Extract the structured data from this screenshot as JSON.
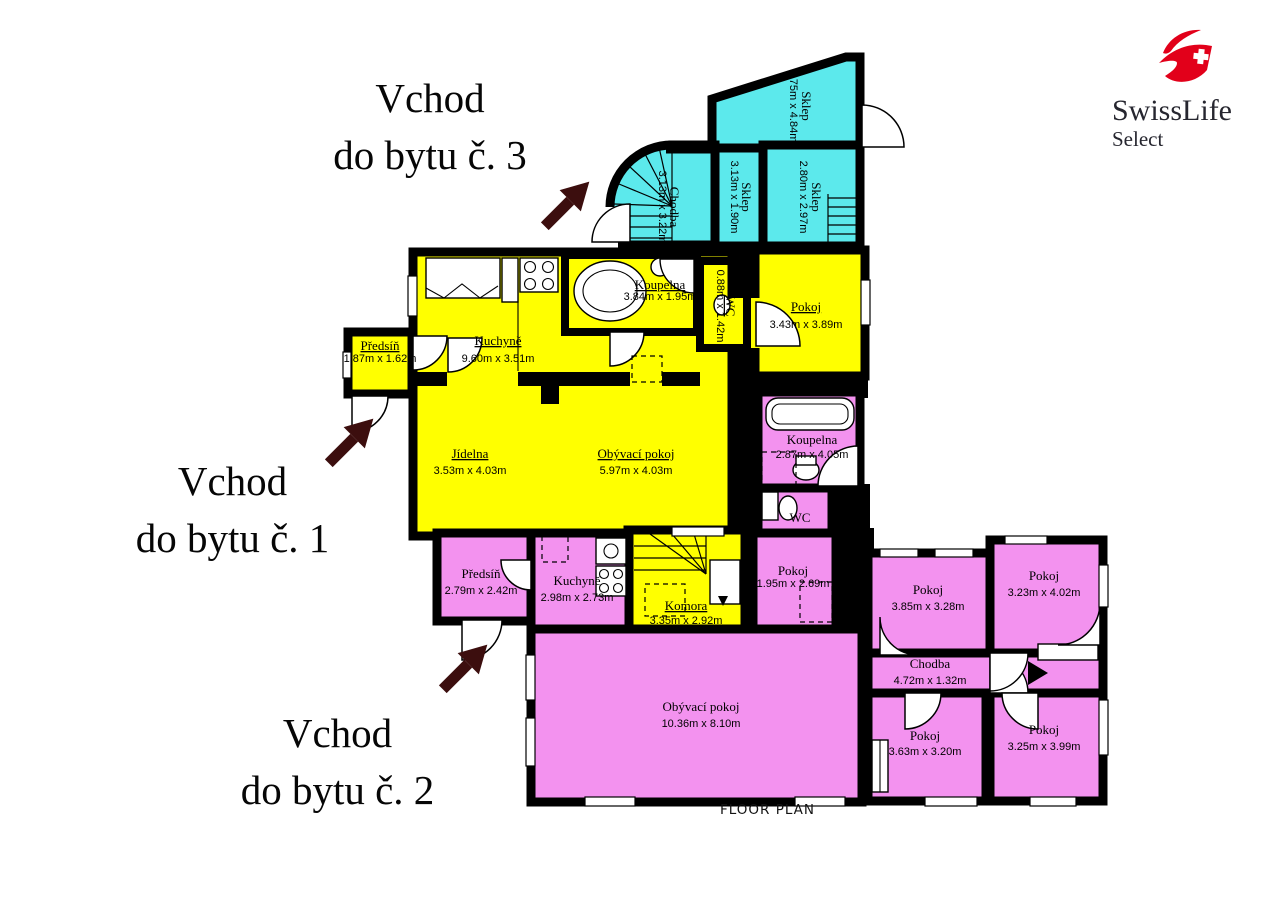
{
  "annotations": {
    "entrance_3": {
      "line1": "Vchod",
      "line2": "do bytu č. 3"
    },
    "entrance_1": {
      "line1": "Vchod",
      "line2": "do bytu č. 1"
    },
    "entrance_2": {
      "line1": "Vchod",
      "line2": "do bytu č. 2"
    }
  },
  "caption": "FLOOR PLAN",
  "logo": {
    "brand": "SwissLife",
    "sub": "Select",
    "red": "#e2001a"
  },
  "colors": {
    "apartment_1": "#ffff00",
    "apartment_2": "#f392ef",
    "apartment_3": "#5ce9ec",
    "walls": "#000000",
    "arrow": "#3c0e0e"
  },
  "rooms": {
    "a3_sklep_top": {
      "name": "Sklep",
      "dims": "1.75m x 4.84m"
    },
    "a3_chodba": {
      "name": "Chodba",
      "dims": "3.13m x 3.22m"
    },
    "a3_sklep_mid": {
      "name": "Sklep",
      "dims": "3.13m x 1.90m"
    },
    "a3_sklep_right": {
      "name": "Sklep",
      "dims": "2.80m x 2.97m"
    },
    "a1_predsin": {
      "name": "Předsíň",
      "dims": "1.87m x 1.62m"
    },
    "a1_kuchyne": {
      "name": "Kuchyně",
      "dims": "9.60m x 3.51m"
    },
    "a1_koupelna": {
      "name": "Koupelna",
      "dims": "3.84m x 1.95m"
    },
    "a1_wc": {
      "name": "WC",
      "dims": "0.88m x 1.42m"
    },
    "a1_pokoj": {
      "name": "Pokoj",
      "dims": "3.43m x 3.89m"
    },
    "a1_jidelna": {
      "name": "Jídelna",
      "dims": "3.53m x 4.03m"
    },
    "a1_obyvaci": {
      "name": "Obývací pokoj",
      "dims": "5.97m x 4.03m"
    },
    "a1_komora": {
      "name": "Komora",
      "dims": "3.35m x 2.92m"
    },
    "a2_koupelna": {
      "name": "Koupelna",
      "dims": "2.87m x 4.05m"
    },
    "a2_wc": {
      "name": "WC"
    },
    "a2_predsin": {
      "name": "Předsíň",
      "dims": "2.79m x 2.42m"
    },
    "a2_kuchyne": {
      "name": "Kuchyně",
      "dims": "2.98m x 2.73m"
    },
    "a2_pokoj_small": {
      "name": "Pokoj",
      "dims": "1.95m x 2.69m"
    },
    "a2_obyvaci": {
      "name": "Obývací pokoj",
      "dims": "10.36m x 8.10m"
    },
    "a2_pokoj_a": {
      "name": "Pokoj",
      "dims": "3.85m x 3.28m"
    },
    "a2_pokoj_b": {
      "name": "Pokoj",
      "dims": "3.23m x 4.02m"
    },
    "a2_chodba": {
      "name": "Chodba",
      "dims": "4.72m x 1.32m"
    },
    "a2_pokoj_c": {
      "name": "Pokoj",
      "dims": "3.63m x 3.20m"
    },
    "a2_pokoj_d": {
      "name": "Pokoj",
      "dims": "3.25m x 3.99m"
    }
  }
}
